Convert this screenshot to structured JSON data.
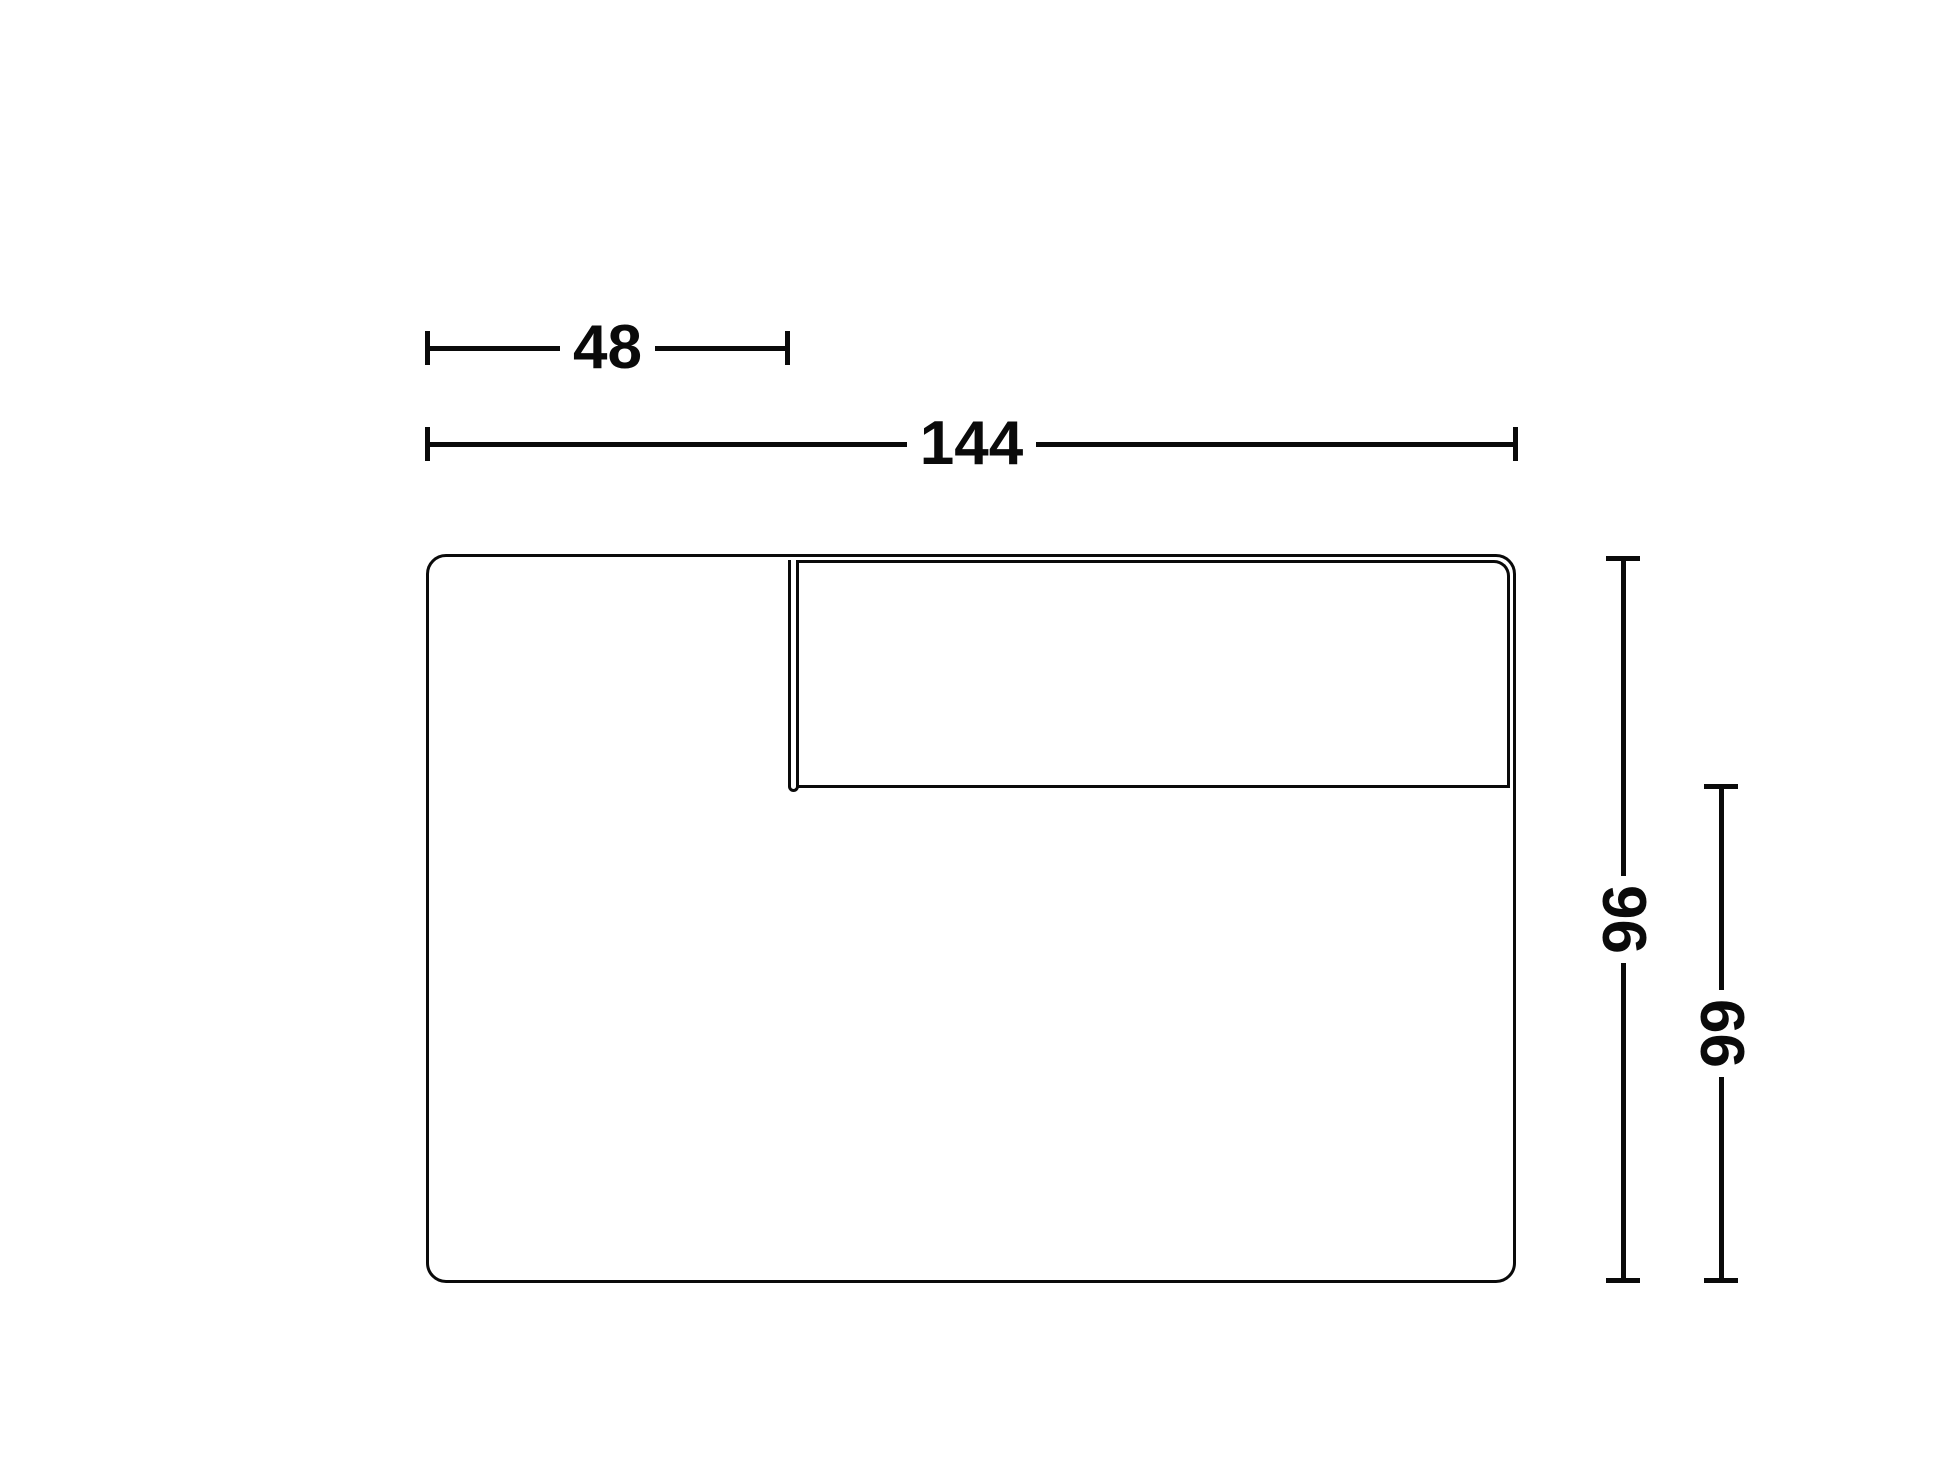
{
  "diagram": {
    "kind": "furniture-module-dimension-drawing",
    "dimensions": {
      "width_partial": "48",
      "width_total": "144",
      "height_total": "96",
      "height_partial": "66"
    },
    "colors": {
      "ink": "#0a0a0a",
      "background": "#ffffff"
    }
  }
}
